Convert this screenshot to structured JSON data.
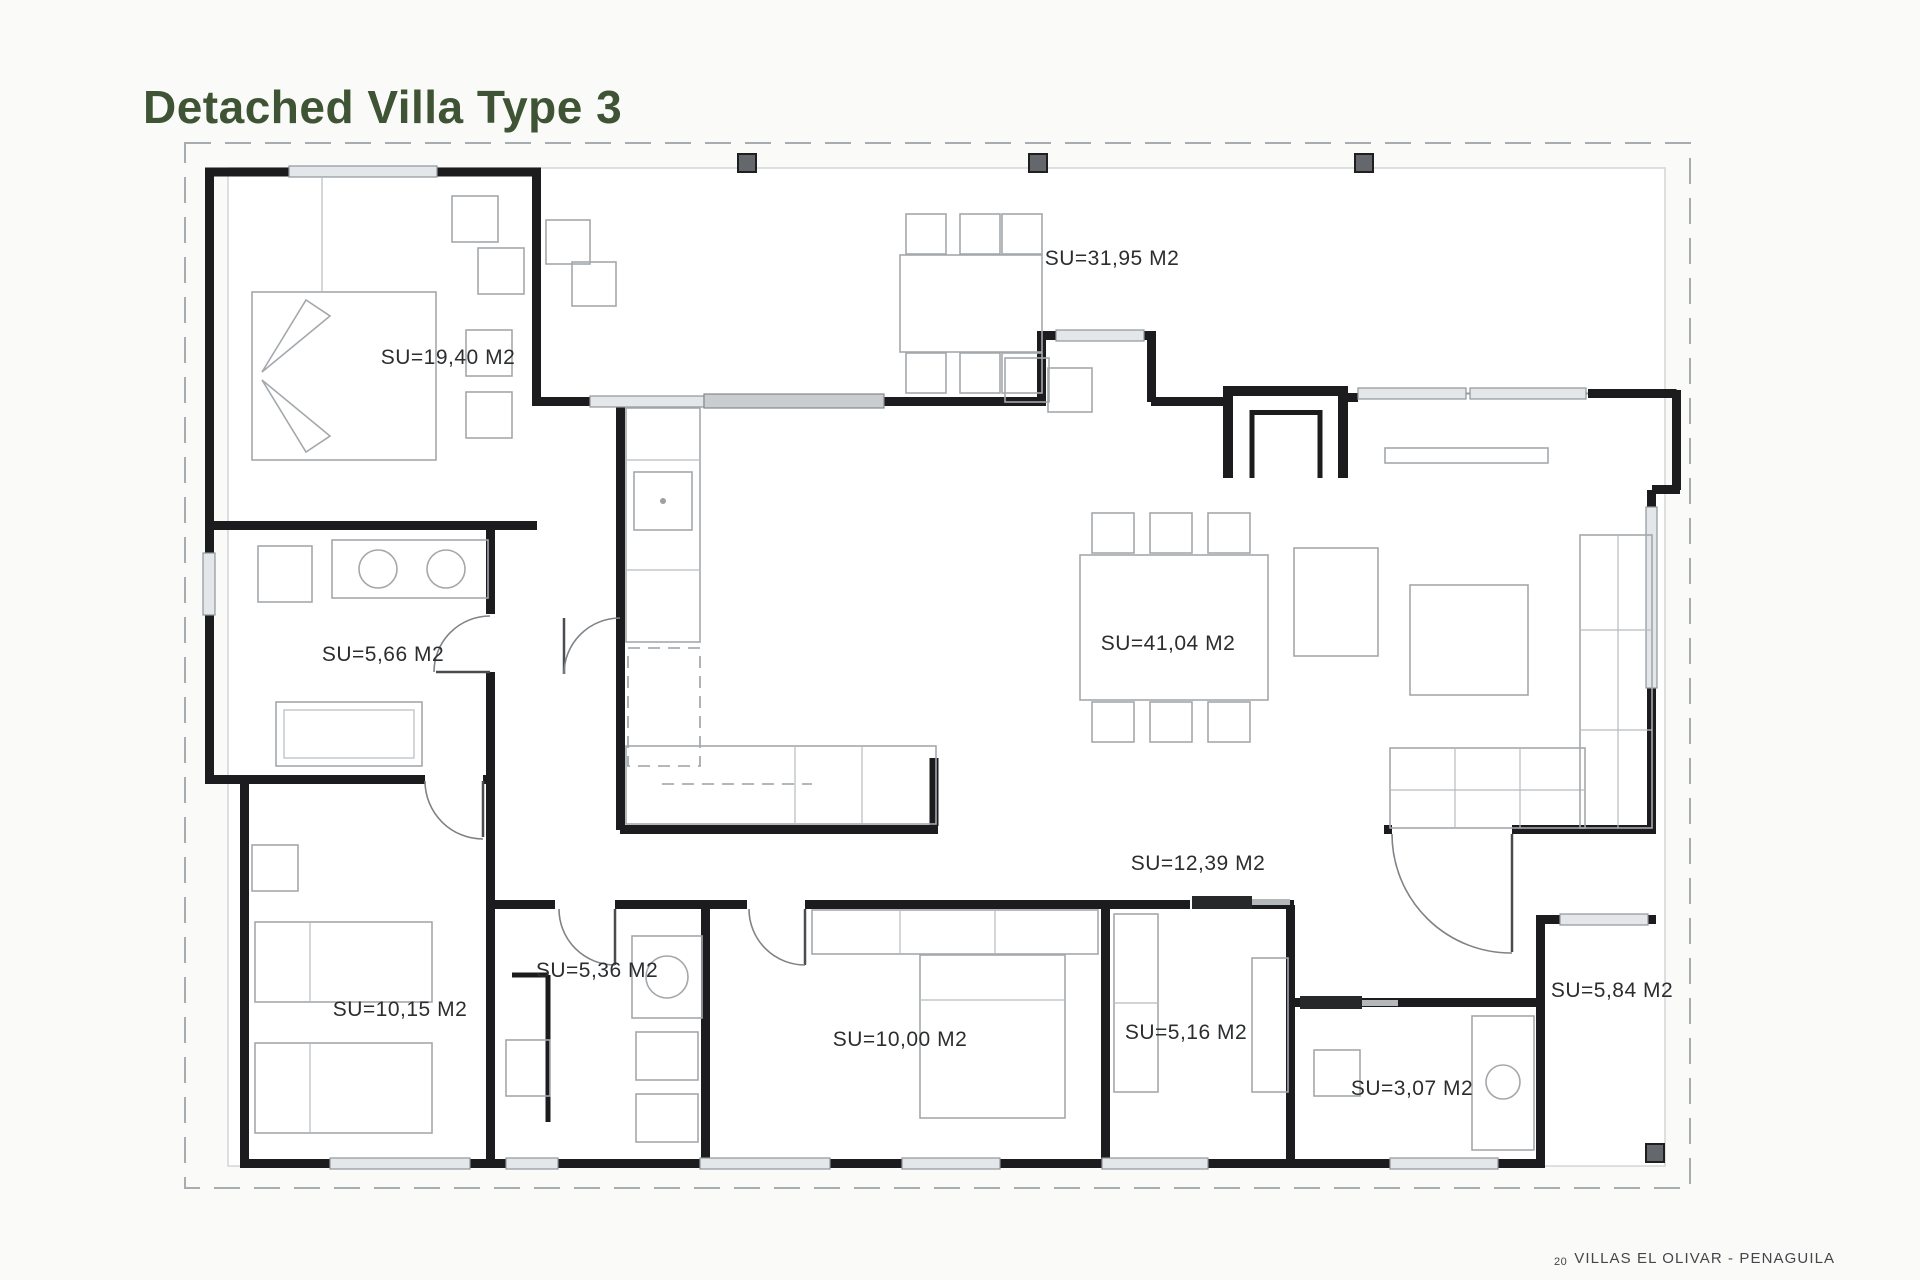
{
  "title": "Detached Villa Type 3",
  "footer": {
    "page_number": "20",
    "project": "VILLAS EL OLIVAR - PENAGUILA"
  },
  "plan": {
    "area_unit": "M2",
    "rooms": [
      {
        "id": "bedroom-1",
        "label": "SU=19,40 M2"
      },
      {
        "id": "terrace",
        "label": "SU=31,95 M2"
      },
      {
        "id": "bathroom-1",
        "label": "SU=5,66 M2"
      },
      {
        "id": "living-dining",
        "label": "SU=41,04 M2"
      },
      {
        "id": "hallway",
        "label": "SU=12,39 M2"
      },
      {
        "id": "bedroom-2",
        "label": "SU=10,15 M2"
      },
      {
        "id": "bathroom-2",
        "label": "SU=5,36 M2"
      },
      {
        "id": "bedroom-3",
        "label": "SU=10,00 M2"
      },
      {
        "id": "dressing",
        "label": "SU=5,16 M2"
      },
      {
        "id": "wc",
        "label": "SU=3,07 M2"
      },
      {
        "id": "porch",
        "label": "SU=5,84 M2"
      }
    ]
  },
  "colors": {
    "title_green": "#3e5434",
    "wall_black": "#1c1c1e",
    "furniture_gray": "#a3a8ac",
    "window_fill": "#e4e7ea",
    "pillar_gray": "#64686c",
    "label_text": "#2b2d2f",
    "background": "#fafaf8"
  }
}
